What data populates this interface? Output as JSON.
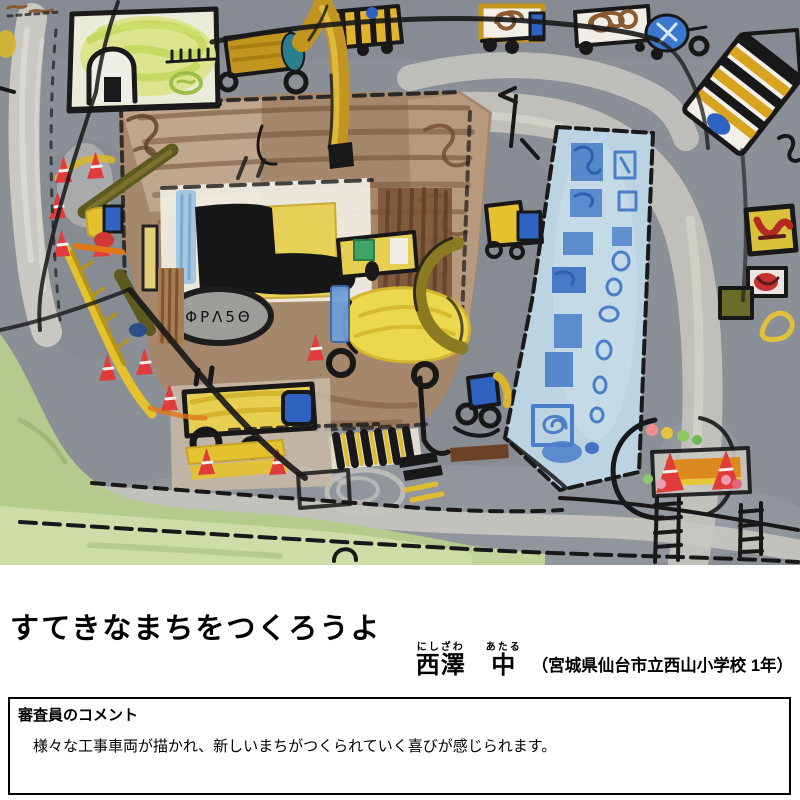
{
  "title": {
    "text": "すてきなまちをつくろうよ"
  },
  "artist": {
    "furigana_last": "にしざわ",
    "furigana_first": "あたる",
    "last_name": "西澤",
    "first_name": "中",
    "affiliation": "（宮城県仙台市立西山小学校 1年）"
  },
  "comment": {
    "heading": "審査員のコメント",
    "body": "　様々な工事車両が描かれ、新しいまちがつくられていく喜びが感じられます。"
  },
  "artwork": {
    "description": "child's crayon and paint drawing of a town under construction: gray roads, brown dirt lot with excavators and work vehicles, light-blue building with blue windows, yellow-green house, striped bus, red cones, green grass",
    "sign_glyphs": "ΦΡΛ5Θ",
    "palette": {
      "road_gray": "#8b8f96",
      "chalk_white": "#cbcac4",
      "grass_green": "#b5cb8d",
      "dirt_brown": "#a5876b",
      "building_blue": "#bcd4e2",
      "window_blue": "#4a7ec9",
      "vehicle_yellow": "#e7cf52",
      "mustard": "#c1951f",
      "cone_red": "#e03c3c",
      "accent_blue": "#2f63c2",
      "teal": "#297f8e",
      "outline_black": "#181818"
    }
  }
}
